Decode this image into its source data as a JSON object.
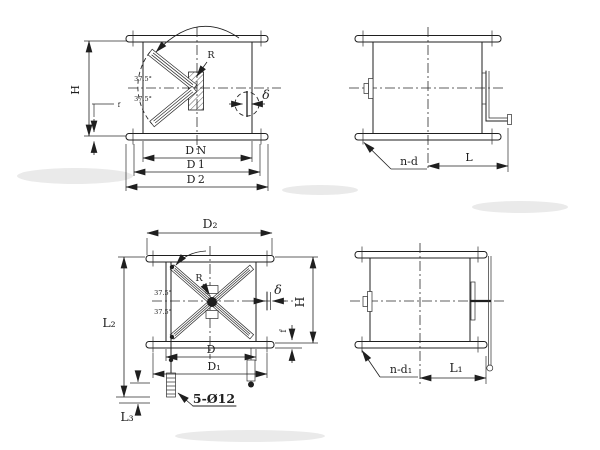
{
  "colors": {
    "ink": "#1f1f1f",
    "paper": "#ffffff"
  },
  "views": {
    "round_front": {
      "labels": {
        "height": "H",
        "flange_thickness": "f",
        "radius": "R",
        "angle_upper": "37.5°",
        "angle_lower": "37.5°",
        "blade_thickness": "δ",
        "nominal_diameter": "DN",
        "bolt_circle": "D1",
        "flange_od": "D2"
      }
    },
    "round_side": {
      "labels": {
        "bolt_holes": "n-d",
        "length": "L"
      }
    },
    "square_front": {
      "labels": {
        "flange_od": "D₂",
        "overall_height": "L₂",
        "base_offset": "L₃",
        "duct_size": "D",
        "bolt_circle": "D₁",
        "height": "H",
        "flange_thickness": "f",
        "blade_thickness": "δ",
        "radius": "R",
        "angle_upper": "37.5°",
        "angle_lower": "37.5°",
        "anchor_bolts": "5-Ø12"
      }
    },
    "square_side": {
      "labels": {
        "bolt_holes": "n-d₁",
        "length": "L₁"
      }
    }
  }
}
